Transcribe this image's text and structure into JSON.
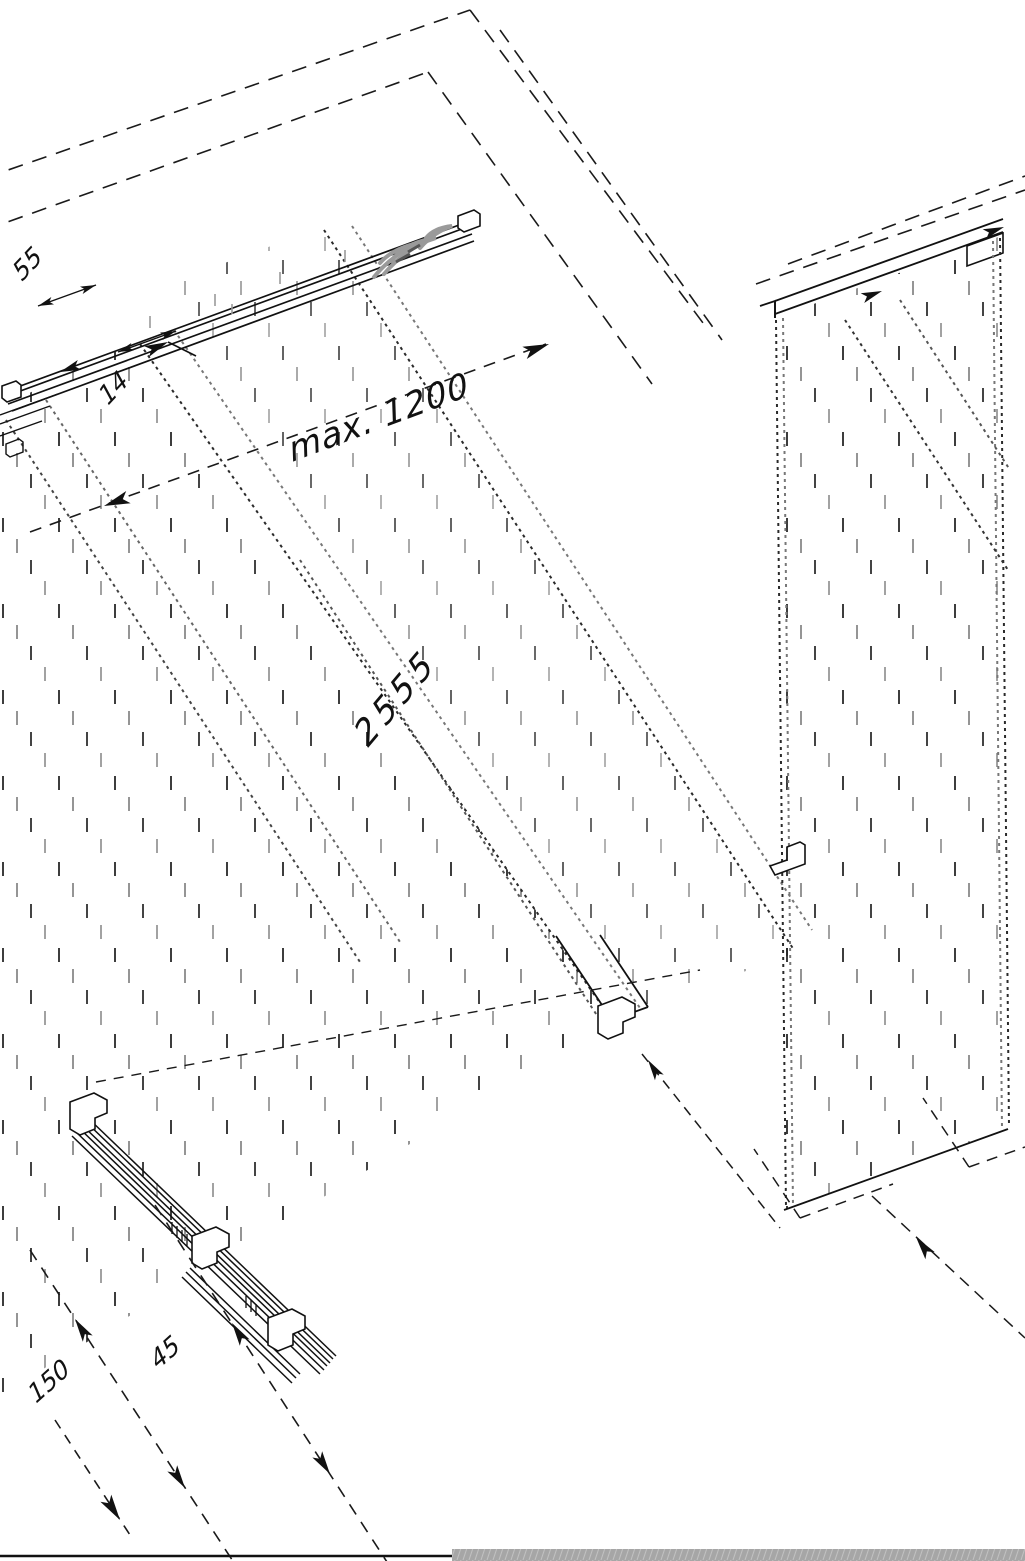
{
  "dimensions": {
    "max_span": "max. 1200",
    "height": "2555",
    "offset_top": "55",
    "thickness": "14",
    "offset_floor": "150",
    "bracket_gap": "45"
  },
  "colors": {
    "ink": "#1a1a1a",
    "gray_ticks": "#8f8f8f",
    "fastener_scribble": "#9a9a9a",
    "bottom_band": "#a6a6a6",
    "background": "#ffffff"
  }
}
